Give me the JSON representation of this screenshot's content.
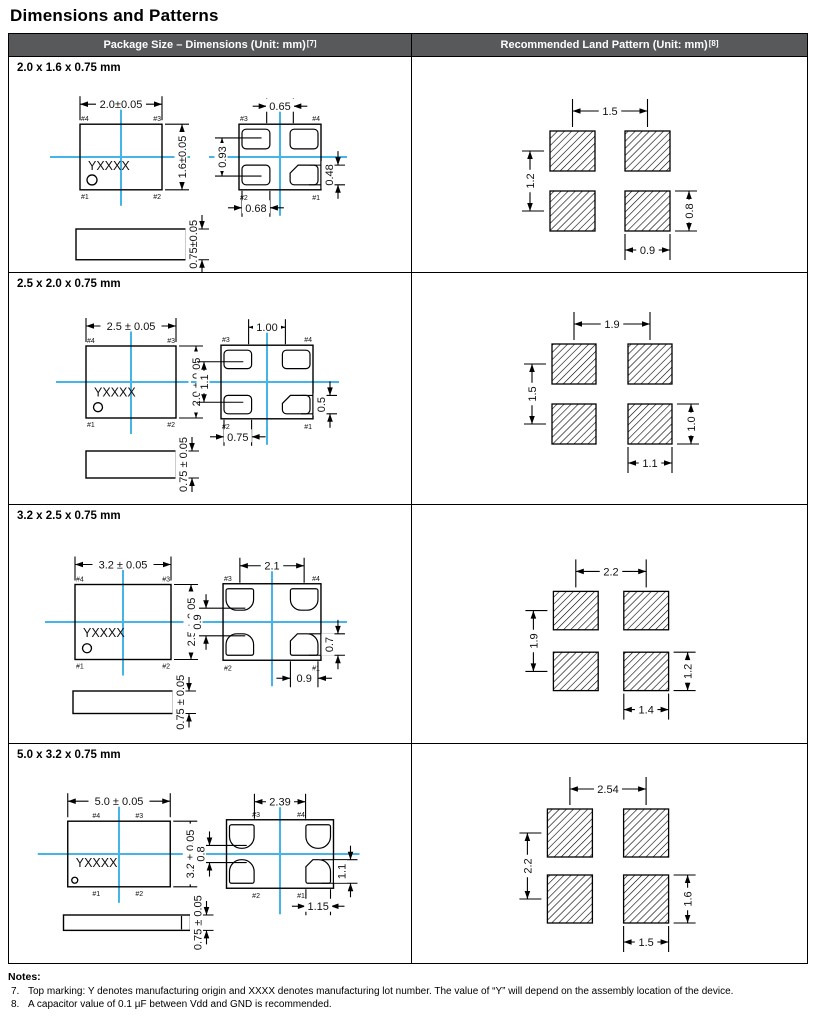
{
  "page_title": "Dimensions and Patterns",
  "colors": {
    "accent_blue": "#45B4E6",
    "header_bg": "#58595B",
    "header_text": "#FFFFFF"
  },
  "table": {
    "headers": [
      {
        "label": "Package Size – Dimensions (Unit: mm)",
        "ref": "[7]"
      },
      {
        "label": "Recommended Land Pattern (Unit: mm)",
        "ref": "[8]"
      }
    ],
    "rows": [
      {
        "size_label": "2.0 x 1.6 x 0.75 mm",
        "top_view": {
          "width_dim": "2.0±0.05",
          "height_dim": "1.6±0.05",
          "thickness_dim": "0.75±0.05",
          "marking": "YXXXX",
          "pin_top_left": "#4",
          "pin_top_right": "#3",
          "pin_bottom_left": "#1",
          "pin_bottom_right": "#2"
        },
        "bottom_view": {
          "top_dim": "0.65",
          "left_dim": "0.93",
          "right_dim": "0.48",
          "bottom_dim": "0.68",
          "pin_top_left": "#3",
          "pin_top_right": "#4",
          "pin_bottom_left": "#2",
          "pin_bottom_right": "#1"
        },
        "land_pattern": {
          "horizontal_pitch": "1.5",
          "vertical_pitch": "1.2",
          "pad_width": "0.9",
          "pad_height": "0.8"
        }
      },
      {
        "size_label": "2.5 x 2.0 x 0.75 mm",
        "top_view": {
          "width_dim": "2.5 ± 0.05",
          "height_dim": "2.0 ± 0.05",
          "thickness_dim": "0.75 ± 0.05",
          "marking": "YXXXX",
          "pin_top_left": "#4",
          "pin_top_right": "#3",
          "pin_bottom_left": "#1",
          "pin_bottom_right": "#2"
        },
        "bottom_view": {
          "top_dim": "1.00",
          "left_dim": "1.1",
          "right_dim": "0.5",
          "bottom_dim": "0.75",
          "pin_top_left": "#3",
          "pin_top_right": "#4",
          "pin_bottom_left": "#2",
          "pin_bottom_right": "#1"
        },
        "land_pattern": {
          "horizontal_pitch": "1.9",
          "vertical_pitch": "1.5",
          "pad_width": "1.1",
          "pad_height": "1.0"
        }
      },
      {
        "size_label": "3.2 x 2.5 x 0.75 mm",
        "top_view": {
          "width_dim": "3.2 ± 0.05",
          "height_dim": "2.5 ± 0.05",
          "thickness_dim": "0.75 ± 0.05",
          "marking": "YXXXX",
          "pin_top_left": "#4",
          "pin_top_right": "#3",
          "pin_bottom_left": "#1",
          "pin_bottom_right": "#2"
        },
        "bottom_view": {
          "top_dim": "2.1",
          "left_dim": "0.9",
          "right_dim": "0.7",
          "bottom_dim": "0.9",
          "pin_top_left": "#3",
          "pin_top_right": "#4",
          "pin_bottom_left": "#2",
          "pin_bottom_right": "#1"
        },
        "land_pattern": {
          "horizontal_pitch": "2.2",
          "vertical_pitch": "1.9",
          "pad_width": "1.4",
          "pad_height": "1.2"
        }
      },
      {
        "size_label": "5.0 x 3.2 x 0.75 mm",
        "top_view": {
          "width_dim": "5.0 ± 0.05",
          "height_dim": "3.2 ± 0.05",
          "thickness_dim": "0.75 ± 0.05",
          "marking": "YXXXX",
          "pin_top_left": "#4",
          "pin_top_right": "#3",
          "pin_bottom_left": "#1",
          "pin_bottom_right": "#2"
        },
        "bottom_view": {
          "top_dim": "2.39",
          "left_dim": "0.8",
          "right_dim": "1.1",
          "bottom_dim": "1.15",
          "pin_top_left": "#3",
          "pin_top_right": "#4",
          "pin_bottom_left": "#2",
          "pin_bottom_right": "#1"
        },
        "land_pattern": {
          "horizontal_pitch": "2.54",
          "vertical_pitch": "2.2",
          "pad_width": "1.5",
          "pad_height": "1.6"
        }
      }
    ]
  },
  "notes": {
    "title": "Notes:",
    "items": [
      {
        "number": "7.",
        "text": "Top marking: Y denotes manufacturing origin and XXXX denotes manufacturing lot number. The value of “Y” will depend on the assembly location of the device."
      },
      {
        "number": "8.",
        "text": "A capacitor value of 0.1 µF between Vdd and GND is recommended."
      }
    ]
  }
}
